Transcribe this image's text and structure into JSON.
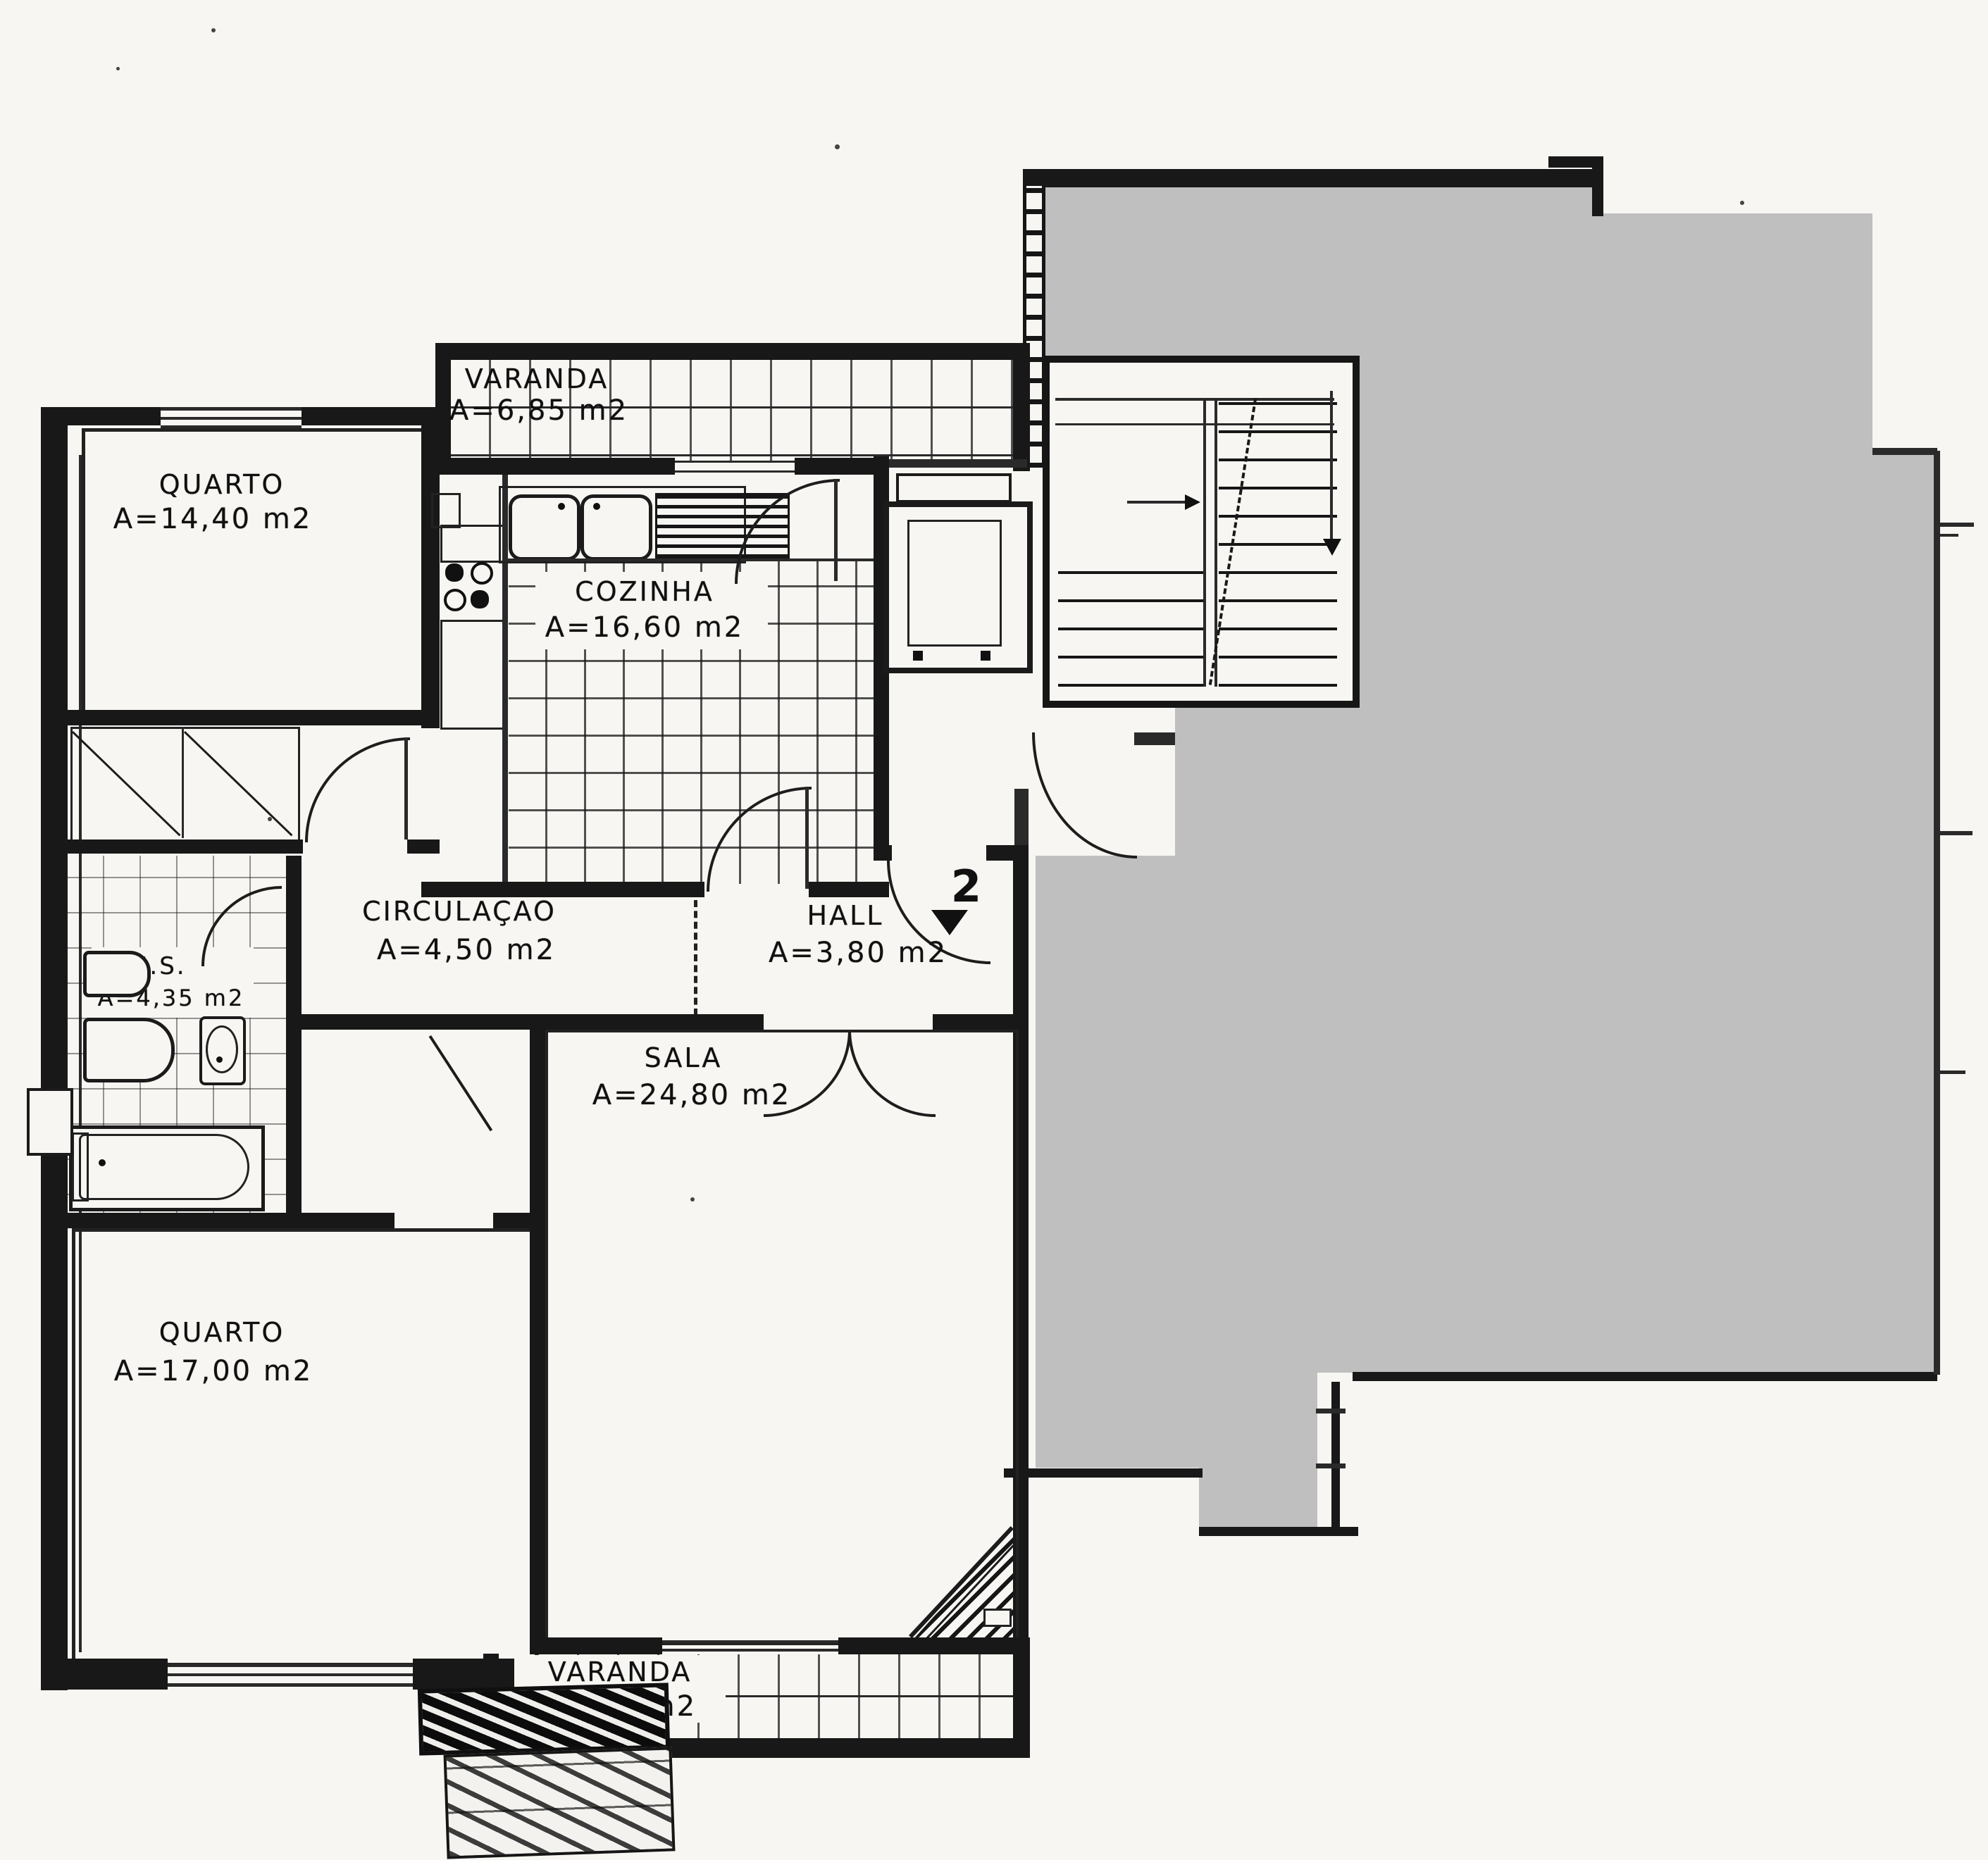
{
  "document": {
    "type": "apartment floor plan (scanned blueprint)",
    "language": "Portuguese"
  },
  "colors": {
    "paper": "#f7f6f2",
    "ink": "#181818",
    "redaction_mask": "#bfbfbf"
  },
  "marker": {
    "apartment_number": "2"
  },
  "rooms": {
    "varanda_top": {
      "name": "VARANDA",
      "area": "A=6,85  m2"
    },
    "quarto_top": {
      "name": "QUARTO",
      "area": "A=14,40  m2"
    },
    "cozinha": {
      "name": "COZINHA",
      "area": "A=16,60  m2"
    },
    "circulacao": {
      "name": "CIRCULAÇAO",
      "area": "A=4,50  m2"
    },
    "hall": {
      "name": "HALL",
      "area": "A=3,80  m2"
    },
    "is": {
      "name": "I.S.",
      "area": "A=4,35  m2"
    },
    "sala": {
      "name": "SALA",
      "area": "A=24,80  m2"
    },
    "quarto_bottom": {
      "name": "QUARTO",
      "area": "A=17,00  m2"
    },
    "varanda_bottom": {
      "name": "VARANDA",
      "area": "A=6,20  m2"
    }
  }
}
